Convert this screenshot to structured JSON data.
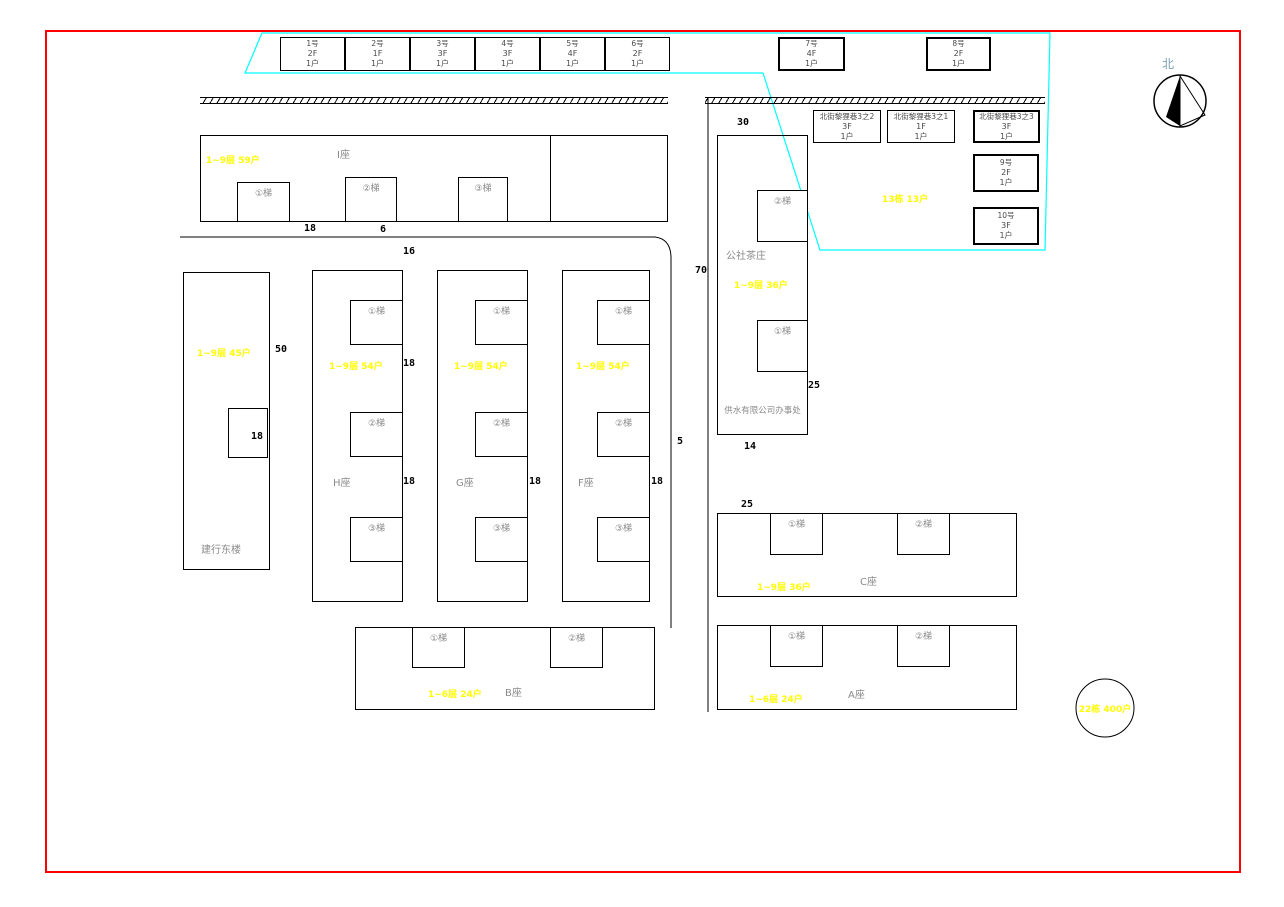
{
  "compass": {
    "north_label": "北"
  },
  "houses_top": [
    {
      "no": "1号",
      "floors": "2F",
      "units": "1户"
    },
    {
      "no": "2号",
      "floors": "1F",
      "units": "1户"
    },
    {
      "no": "3号",
      "floors": "3F",
      "units": "1户"
    },
    {
      "no": "4号",
      "floors": "3F",
      "units": "1户"
    },
    {
      "no": "5号",
      "floors": "4F",
      "units": "1户"
    },
    {
      "no": "6号",
      "floors": "2F",
      "units": "1户"
    }
  ],
  "house7": {
    "no": "7号",
    "floors": "4F",
    "units": "1户"
  },
  "house8": {
    "no": "8号",
    "floors": "2F",
    "units": "1户"
  },
  "lane_houses": [
    {
      "no": "北街黎狸巷3之2",
      "floors": "3F",
      "units": "1户"
    },
    {
      "no": "北街黎狸巷3之1",
      "floors": "1F",
      "units": "1户"
    },
    {
      "no": "北街黎狸巷3之3",
      "floors": "3F",
      "units": "1户"
    },
    {
      "no": "9号",
      "floors": "2F",
      "units": "1户"
    },
    {
      "no": "10号",
      "floors": "3F",
      "units": "1户"
    }
  ],
  "lane_total": "13栋 13户",
  "buildings": {
    "i": {
      "name": "I座",
      "annot": "1~9层 59户",
      "stairs": [
        "①梯",
        "②梯",
        "③梯"
      ]
    },
    "h": {
      "name": "H座",
      "annot": "1~9层 54户",
      "stairs": [
        "①梯",
        "②梯",
        "③梯"
      ]
    },
    "g": {
      "name": "G座",
      "annot": "1~9层 54户",
      "stairs": [
        "①梯",
        "②梯",
        "③梯"
      ]
    },
    "f": {
      "name": "F座",
      "annot": "1~9层 54户",
      "stairs": [
        "①梯",
        "②梯",
        "③梯"
      ]
    },
    "bank": {
      "name": "建行东楼",
      "annot": "1~9层 45户"
    },
    "tea": {
      "name": "公社茶庄",
      "annot": "1~9层 36户",
      "stairs": [
        "②梯",
        "①梯"
      ],
      "office": "供水有限公司办事处"
    },
    "b": {
      "name": "B座",
      "annot": "1~6层 24户",
      "stairs": [
        "①梯",
        "②梯"
      ]
    },
    "c": {
      "name": "C座",
      "annot": "1~9层 36户",
      "stairs": [
        "①梯",
        "②梯"
      ]
    },
    "a": {
      "name": "A座",
      "annot": "1~6层 24户",
      "stairs": [
        "①梯",
        "②梯"
      ]
    }
  },
  "total_badge": "22栋 400户",
  "dimensions": [
    "18",
    "6",
    "16",
    "30",
    "70",
    "50",
    "18",
    "18",
    "18",
    "18",
    "18",
    "5",
    "25",
    "14",
    "25"
  ],
  "colors": {
    "boundary_red": "#ff0000",
    "parcel_cyan": "#00ffff",
    "annotation_yellow": "#ffff00",
    "label_gray": "#8a8a8a"
  }
}
